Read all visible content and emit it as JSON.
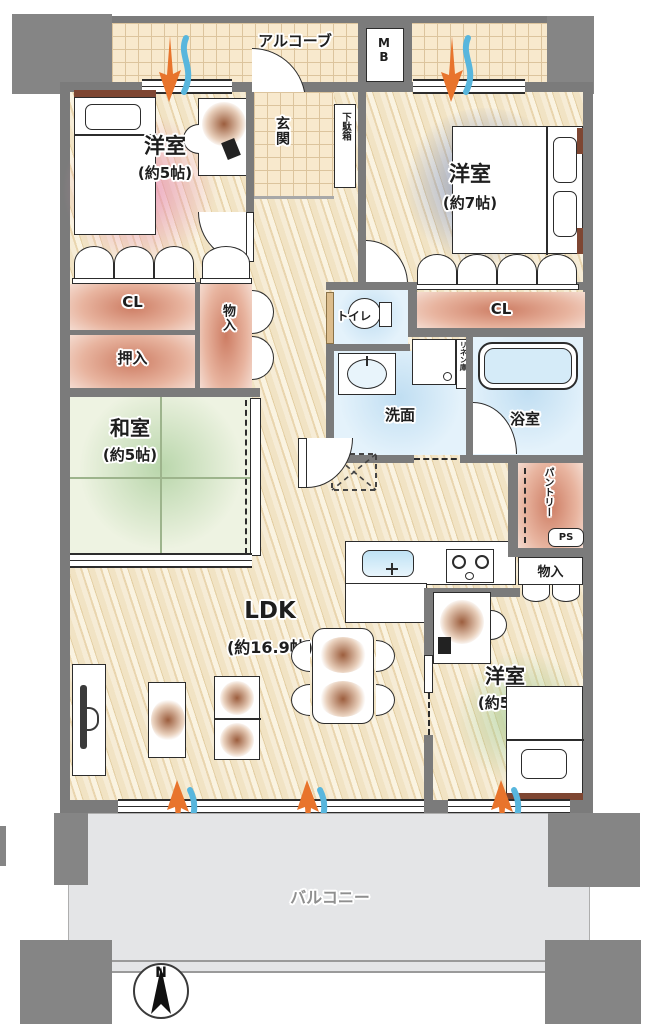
{
  "labels": {
    "alcove": "アルコーブ",
    "mb": "MB",
    "entrance": "玄関",
    "shoe_box": "下駄箱",
    "bedroom_nw_name": "洋室",
    "bedroom_nw_size": "(約5帖)",
    "bedroom_ne_name": "洋室",
    "bedroom_ne_size": "(約7帖)",
    "closet_nw": "CL",
    "oshiire": "押入",
    "storage_hall": "物入",
    "toilet": "トイレ",
    "closet_ne": "CL",
    "japanese_room_name": "和室",
    "japanese_room_size": "(約5帖)",
    "washroom": "洗面",
    "linen": "リネン庫",
    "bathroom": "浴室",
    "pantry": "パントリー",
    "pipe_space": "PS",
    "storage_se": "物入",
    "ldk_name": "LDK",
    "ldk_size": "(約16.9帖)",
    "bedroom_se_name": "洋室",
    "bedroom_se_size": "(約5帖)",
    "balcony": "バルコニー",
    "compass_north": "N"
  },
  "colors": {
    "wall": "#7b7b7b",
    "wood_floor": "#f2e5c9",
    "tile_floor": "#f8e9cd",
    "water_rooms": "#e4f2fb",
    "tatami": "#eef3e2",
    "balcony_floor": "#e4e5e7",
    "closet_gradient": "#cd7d64",
    "bedroom_nw_tint": "#e78cb4",
    "bedroom_ne_tint": "#5a78be",
    "bedroom_se_tint": "#96c88c",
    "vent_warm": "#e8742c",
    "vent_cool": "#58b6dd"
  }
}
